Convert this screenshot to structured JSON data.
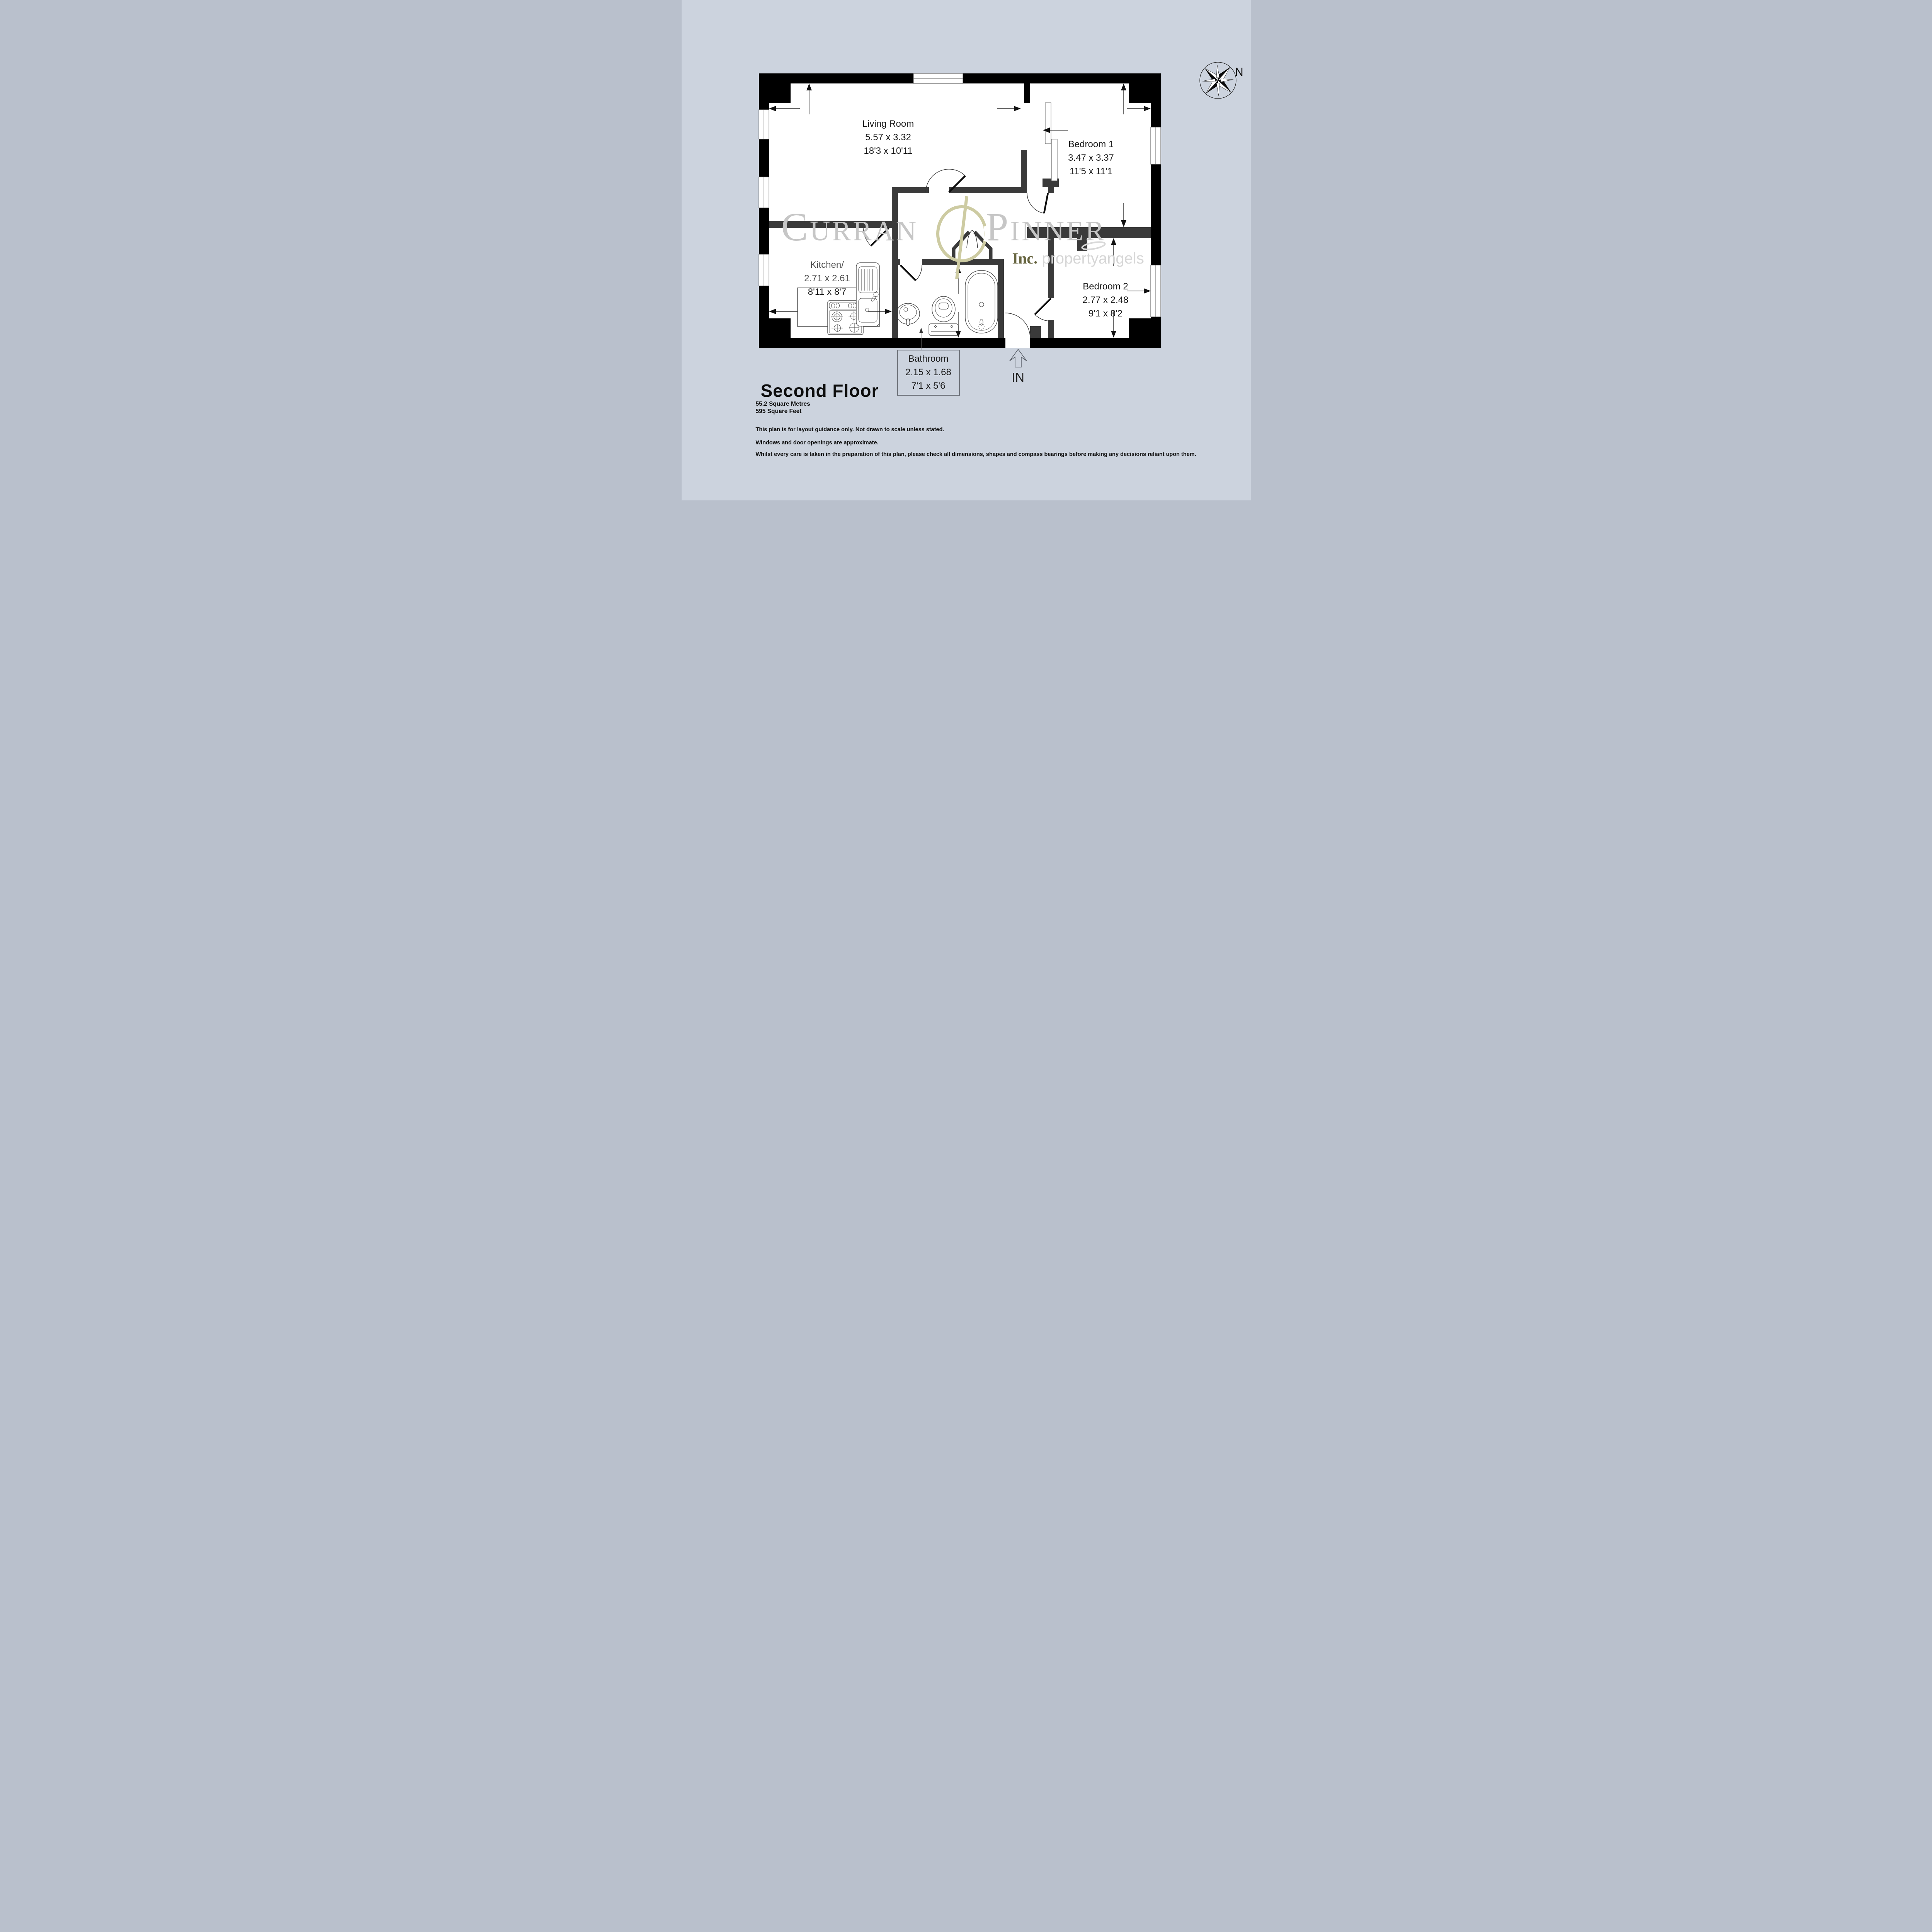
{
  "floor": {
    "title": "Second Floor",
    "area_metric": "55.2 Square Metres",
    "area_imperial": "595 Square Feet"
  },
  "disclaimers": [
    "This plan is for layout guidance only. Not drawn to scale unless stated.",
    "Windows and door openings are approximate.",
    "Whilst every care is taken in the preparation of this plan, please check all dimensions, shapes and compass bearings before making any decisions reliant upon them."
  ],
  "rooms": [
    {
      "name": "Living Room",
      "metric": "5.57 x 3.32",
      "imperial": "18'3 x 10'11"
    },
    {
      "name": "Bedroom 1",
      "metric": "3.47 x 3.37",
      "imperial": "11'5 x 11'1"
    },
    {
      "name": "Kitchen/",
      "metric": "2.71 x 2.61",
      "imperial": "8'11 x 8'7"
    },
    {
      "name": "Bedroom 2",
      "metric": "2.77 x 2.48",
      "imperial": "9'1 x 8'2"
    },
    {
      "name": "Bathroom",
      "metric": "2.15 x 1.68",
      "imperial": "7'1 x 5'6"
    }
  ],
  "entrance": {
    "label": "IN"
  },
  "compass": {
    "label": "N"
  },
  "watermark": {
    "name_left": "Curran",
    "name_right": "Pinner",
    "sub_prefix": "Inc.",
    "sub_brand": "propertyangels"
  },
  "colors": {
    "background": "#ccd3de",
    "outer_wall": "#000000",
    "interior_wall": "#3a3a3a",
    "watermark_text": "#c6c6c6",
    "watermark_accent": "#cdcba2",
    "watermark_accent_dark": "#4c4a1e"
  }
}
